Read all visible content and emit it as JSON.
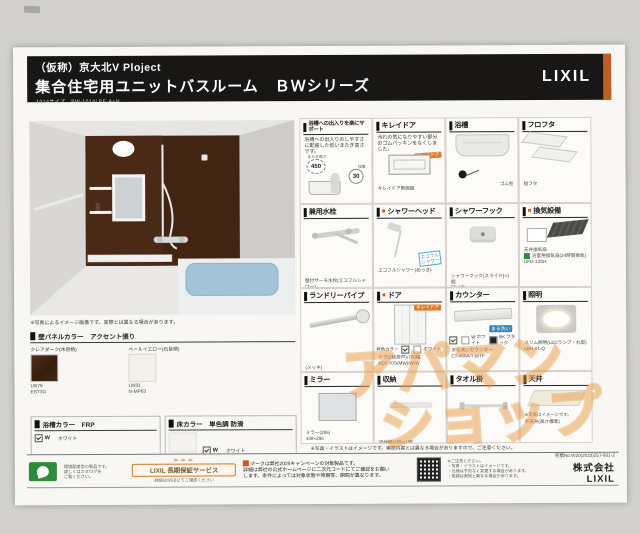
{
  "header": {
    "project": "（仮称）京大北V Ploject",
    "title": "集合住宅用ユニットバスルーム　ＢＷシリーズ",
    "size_code": "1014サイズ　BW-1014LBE-A+H",
    "brand": "LIXIL"
  },
  "left": {
    "render_caption": "※写真によるイメージ画像です。実際とは異なる場合があります。",
    "wall_panel": {
      "heading": "壁パネルカラー　アクセント張り",
      "accent": {
        "label": "クレアダーク(木目柄)",
        "code1": "LW76",
        "code2": "EST3G"
      },
      "base": {
        "label": "ベールイエロー(石目柄)",
        "code1": "LW81",
        "code2": "N-MP63"
      }
    },
    "tub_color": {
      "heading": "浴槽カラー　FRP",
      "check": "W",
      "label": "ホワイト"
    },
    "floor_color": {
      "heading": "床カラー　単色調 防滑",
      "check": "W",
      "label": "ホワイト"
    }
  },
  "products": [
    {
      "title": "浴槽への出入りを楽にサポート",
      "body": "浴槽への出入りのしやすさに配慮した低いまたぎ高さです。",
      "badge_a": "450",
      "badge_a_label": "またぎ高さ",
      "badge_b": "30",
      "badge_b_label": "段差"
    },
    {
      "title": "キレイドア",
      "body": "汚れの気になりやすい部分のゴムパッキンをなくしました。",
      "badge": "キレイドア",
      "captions": [
        "キレイドア断面図"
      ]
    },
    {
      "title": "浴槽",
      "captions": [
        "ゴム栓"
      ]
    },
    {
      "title": "フロフタ",
      "captions": [
        "組フタ"
      ]
    },
    {
      "title": "兼用水栓",
      "captions": [
        "壁付サーモ水栓(エコフルシャワー)",
        "BF-M140T"
      ]
    },
    {
      "marker": "■",
      "title": "シャワーヘッド",
      "badge": "エコフル\nシャワー",
      "captions": [
        "エコフルシャワー(めっき)"
      ]
    },
    {
      "title": "シャワーフック",
      "captions": [
        "シャワーフック(スライド)×1個",
        "SF-HB"
      ]
    },
    {
      "marker": "■",
      "title": "換気設備",
      "captions": [
        "天井換気扇",
        "浴室用換気扇(24時間換気)",
        "UFD-13SH"
      ]
    },
    {
      "title": "ランドリーパイプ",
      "captions": [
        "(メッキ)",
        "LAP-MM2-W (W1本)"
      ]
    },
    {
      "marker": "■",
      "title": "ドア",
      "badge": "キレイドア",
      "frame_label": "枠色カラー",
      "frame_color": "ホワイト",
      "captions": [
        "ドア(2枚折戸)/700幅",
        "PDT-70S(MW)/W-W"
      ]
    },
    {
      "title": "カウンター",
      "badge": "まる洗い",
      "swatch_w": "W ホワイト",
      "swatch_bk": "BK ブラック",
      "captions": [
        "まる洗いカウンター",
        "CT-460A/T-B/TF"
      ]
    },
    {
      "title": "照明",
      "captions": [
        "スリム照明(LEDランプ・丸型)",
        "LBH-01-Q"
      ]
    },
    {
      "title": "ミラー",
      "captions": [
        "ミラー(295)",
        "438×295"
      ]
    },
    {
      "title": "収納",
      "captions": [
        "収納棚(2段)×1個",
        "SF-10SB-23/N1"
      ]
    },
    {
      "title": "タオル掛",
      "captions": [
        "TB-450-N"
      ]
    },
    {
      "title": "天井",
      "note": "※写真はイメージです。",
      "captions": [
        "平天井(高さ標準)"
      ]
    }
  ],
  "grid_note": "※写真・イラストはイメージです。実際内容とは異なる場合がありますので、ご注意ください。",
  "footer": {
    "eco_lines": [
      "環境配慮型の製品です。",
      "詳しくはカタログを",
      "ご覧ください。"
    ],
    "warranty": {
      "arrows": "≫≫≫",
      "label": "LIXIL 長期保証サービス",
      "sub": "詳細はWEBにてご確認ください"
    },
    "campaign": [
      "マークは弊社2025キャンペーンの対象製品です。",
      "詳細は弊社の公式ホームページに二次元コードにてご確認をお願い",
      "します。条件によっては対象状態や時期等、期間が異なります。"
    ],
    "notes": [
      "※ご注意ください。",
      "・写真・イラストはイメージです。",
      "・仕様は予告なく変更する場合があります。",
      "・色調は実物と異なる場合があります。"
    ],
    "quote_no": "見積No.W20(2023)257-801-2",
    "company": "株式会社LIXIL"
  },
  "watermark": {
    "line1": "アパマン",
    "line2": "ショップ"
  },
  "colors": {
    "header_bar": "#181715",
    "accent_orange": "#bf5e24",
    "accent_panel": "#46281a",
    "base_panel": "#f3f1ea",
    "badge_orange": "#e07a28",
    "badge_blue": "#2f86c0",
    "eco_green": "#2e8b3a",
    "watermark_orange": "#e8963f",
    "tub_water": "#a3c3d8"
  }
}
